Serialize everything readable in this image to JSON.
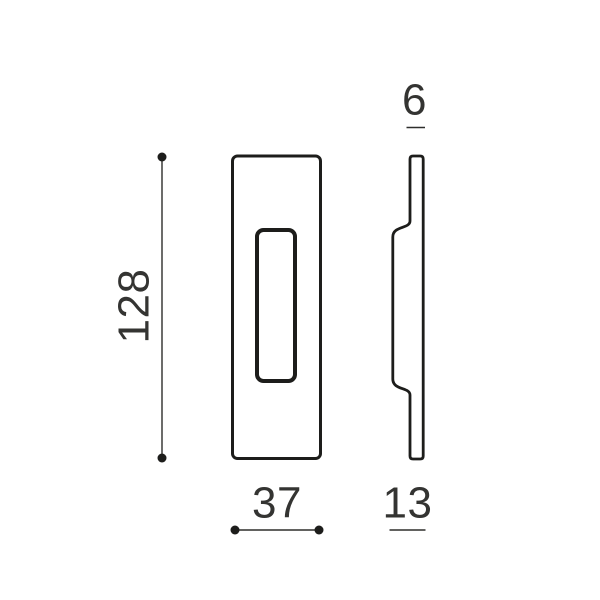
{
  "canvas": {
    "background": "#ffffff"
  },
  "drawing": {
    "line_color": "#1d1d1b",
    "dim_line_color": "#2e2e2c",
    "text_color": "#343432",
    "dimensions": {
      "height": "128",
      "width": "37",
      "thickness": "6",
      "depth": "13"
    }
  }
}
